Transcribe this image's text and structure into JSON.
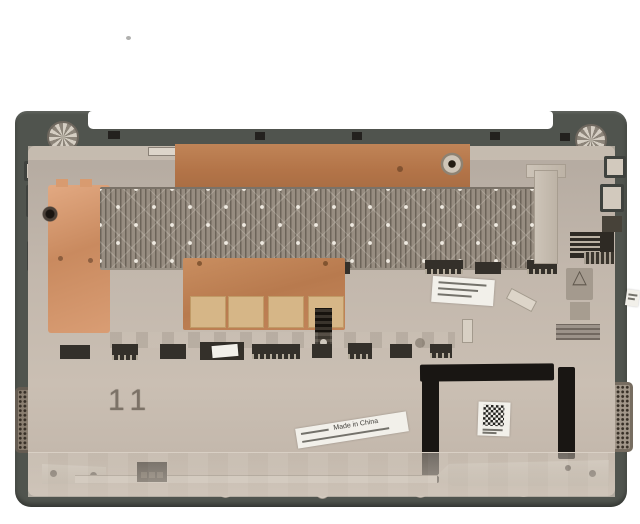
{
  "scene": {
    "subject": "laptop bottom base cover, inner side up, product photo",
    "background_color": "#ffffff"
  },
  "markings": {
    "mold_number": "11",
    "origin_label": "Made in China"
  },
  "icons": {
    "recycle_triangle": "△"
  },
  "colors": {
    "rim": "#50544e",
    "inner_shell": "#c2b7ac",
    "copper": "#b97c52",
    "vent": "#8f867b",
    "bracket_black": "#191613",
    "thermal_pad": "#d6b687",
    "label_white": "#f2f0ea"
  }
}
